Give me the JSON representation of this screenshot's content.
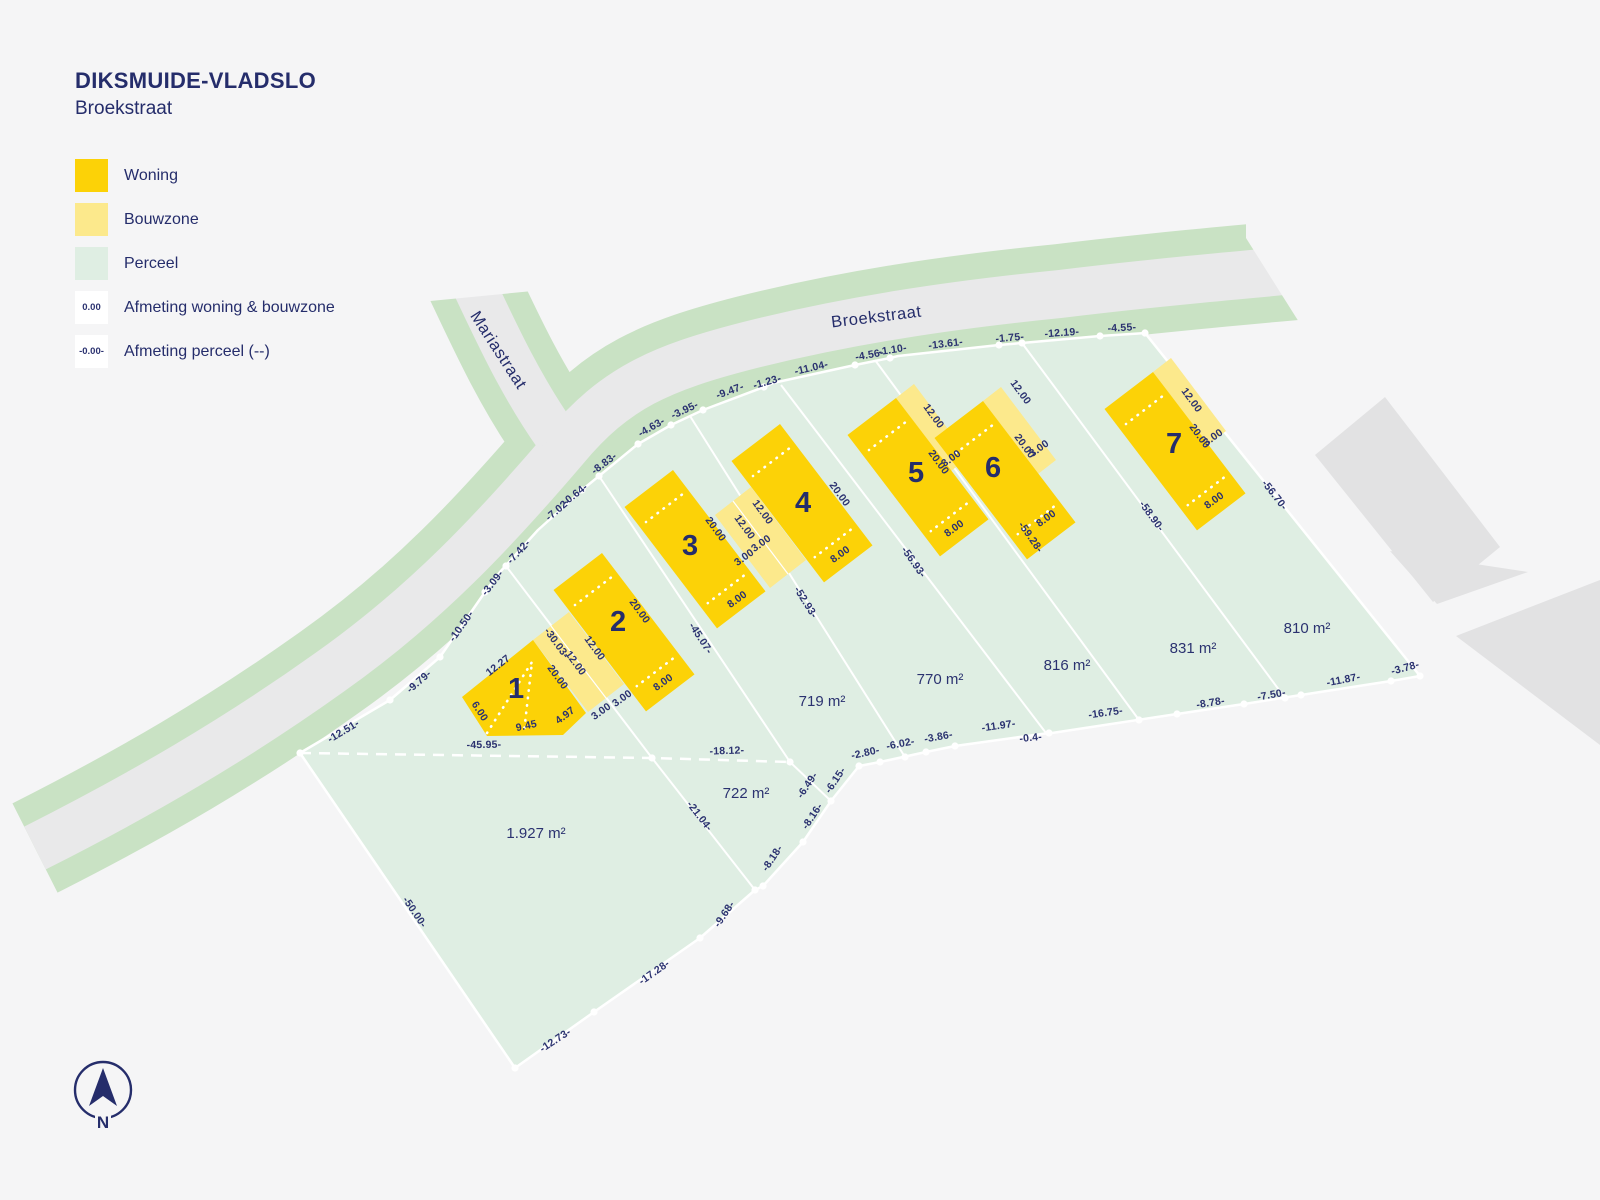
{
  "header": {
    "title": "DIKSMUIDE-VLADSLO",
    "subtitle": "Broekstraat"
  },
  "legend": {
    "items": [
      {
        "label": "Woning",
        "swatch": "woning"
      },
      {
        "label": "Bouwzone",
        "swatch": "bouwzone"
      },
      {
        "label": "Perceel",
        "swatch": "perceel"
      },
      {
        "label": "Afmeting woning & bouwzone",
        "swatch": "text",
        "swatch_text": "0.00"
      },
      {
        "label": "Afmeting perceel (--)",
        "swatch": "text",
        "swatch_text": "-0.00-"
      }
    ]
  },
  "north": {
    "label": "N"
  },
  "colors": {
    "woning": "#fcd207",
    "bouwzone": "#fce98c",
    "perceel": "#dfeee3",
    "road": "#e9e9ea",
    "verge": "#c9e2c4",
    "text": "#2b3270",
    "background": "#f5f5f6"
  },
  "plan": {
    "streets": [
      {
        "name": "Broekstraat",
        "x": 877,
        "y": 322,
        "rot": -7
      },
      {
        "name": "Mariastraat",
        "x": 494,
        "y": 353,
        "rot": 57
      }
    ],
    "lots": [
      {
        "number": "1",
        "x": 516,
        "y": 698
      },
      {
        "number": "2",
        "x": 618,
        "y": 631
      },
      {
        "number": "3",
        "x": 690,
        "y": 555
      },
      {
        "number": "4",
        "x": 803,
        "y": 512
      },
      {
        "number": "5",
        "x": 916,
        "y": 482
      },
      {
        "number": "6",
        "x": 993,
        "y": 477
      },
      {
        "number": "7",
        "x": 1174,
        "y": 453
      }
    ],
    "areas": [
      {
        "text": "1.927 m²",
        "x": 536,
        "y": 838
      },
      {
        "text": "722 m²",
        "x": 746,
        "y": 798
      },
      {
        "text": "719 m²",
        "x": 822,
        "y": 706
      },
      {
        "text": "770 m²",
        "x": 940,
        "y": 684
      },
      {
        "text": "816 m²",
        "x": 1067,
        "y": 670
      },
      {
        "text": "831 m²",
        "x": 1193,
        "y": 653
      },
      {
        "text": "810 m²",
        "x": 1307,
        "y": 633
      }
    ],
    "building_dims": [
      {
        "text": "12.27",
        "x": 500,
        "y": 668,
        "rot": -38
      },
      {
        "text": "20.00",
        "x": 555,
        "y": 679,
        "rot": 54
      },
      {
        "text": "6.00",
        "x": 477,
        "y": 713,
        "rot": 57
      },
      {
        "text": "9.45",
        "x": 527,
        "y": 729,
        "rot": -12
      },
      {
        "text": "4.97",
        "x": 567,
        "y": 718,
        "rot": -37
      },
      {
        "text": "12.00",
        "x": 573,
        "y": 665,
        "rot": 54
      },
      {
        "text": "12.00",
        "x": 592,
        "y": 650,
        "rot": 54
      },
      {
        "text": "3.00",
        "x": 603,
        "y": 714,
        "rot": -36
      },
      {
        "text": "3.00",
        "x": 624,
        "y": 701,
        "rot": -36
      },
      {
        "text": "20.00",
        "x": 637,
        "y": 613,
        "rot": 54
      },
      {
        "text": "8.00",
        "x": 665,
        "y": 685,
        "rot": -36
      },
      {
        "text": "12.00",
        "x": 742,
        "y": 529,
        "rot": 54
      },
      {
        "text": "12.00",
        "x": 760,
        "y": 514,
        "rot": 54
      },
      {
        "text": "3.00",
        "x": 746,
        "y": 560,
        "rot": -36
      },
      {
        "text": "3.00",
        "x": 763,
        "y": 546,
        "rot": -36
      },
      {
        "text": "20.00",
        "x": 713,
        "y": 531,
        "rot": 54
      },
      {
        "text": "8.00",
        "x": 739,
        "y": 602,
        "rot": -36
      },
      {
        "text": "20.00",
        "x": 837,
        "y": 496,
        "rot": 54
      },
      {
        "text": "8.00",
        "x": 842,
        "y": 557,
        "rot": -36
      },
      {
        "text": "20.00",
        "x": 936,
        "y": 464,
        "rot": 54
      },
      {
        "text": "8.00",
        "x": 956,
        "y": 531,
        "rot": -36
      },
      {
        "text": "12.00",
        "x": 931,
        "y": 418,
        "rot": 54
      },
      {
        "text": "3.00",
        "x": 953,
        "y": 461,
        "rot": -36
      },
      {
        "text": "20.00",
        "x": 1022,
        "y": 448,
        "rot": 54
      },
      {
        "text": "8.00",
        "x": 1048,
        "y": 521,
        "rot": -36
      },
      {
        "text": "12.00",
        "x": 1018,
        "y": 394,
        "rot": 54
      },
      {
        "text": "3.00",
        "x": 1041,
        "y": 451,
        "rot": -36
      },
      {
        "text": "20.00",
        "x": 1197,
        "y": 438,
        "rot": 54
      },
      {
        "text": "8.00",
        "x": 1216,
        "y": 503,
        "rot": -36
      },
      {
        "text": "12.00",
        "x": 1189,
        "y": 402,
        "rot": 54
      },
      {
        "text": "3.00",
        "x": 1215,
        "y": 440,
        "rot": -36
      }
    ],
    "parcel_dims": [
      {
        "text": "-12.51-",
        "x": 345,
        "y": 734,
        "rot": -31
      },
      {
        "text": "-9.79-",
        "x": 421,
        "y": 684,
        "rot": -41
      },
      {
        "text": "-10.50-",
        "x": 464,
        "y": 628,
        "rot": -55
      },
      {
        "text": "-3.09-",
        "x": 495,
        "y": 585,
        "rot": -52
      },
      {
        "text": "-7.42-",
        "x": 521,
        "y": 554,
        "rot": -47
      },
      {
        "text": "-7.02-",
        "x": 560,
        "y": 512,
        "rot": -40
      },
      {
        "text": "-0.64-",
        "x": 577,
        "y": 497,
        "rot": -38
      },
      {
        "text": "-8.83-",
        "x": 606,
        "y": 466,
        "rot": -37
      },
      {
        "text": "-4.63-",
        "x": 653,
        "y": 430,
        "rot": -30
      },
      {
        "text": "-3.95-",
        "x": 686,
        "y": 413,
        "rot": -25
      },
      {
        "text": "-9.47-",
        "x": 731,
        "y": 394,
        "rot": -20
      },
      {
        "text": "-1.23-",
        "x": 768,
        "y": 385,
        "rot": -16
      },
      {
        "text": "-11.04-",
        "x": 812,
        "y": 371,
        "rot": -13
      },
      {
        "text": "-4.56-",
        "x": 870,
        "y": 358,
        "rot": -10
      },
      {
        "text": "-1.10-",
        "x": 893,
        "y": 353,
        "rot": -9
      },
      {
        "text": "-13.61-",
        "x": 946,
        "y": 347,
        "rot": -7
      },
      {
        "text": "-1.75-",
        "x": 1010,
        "y": 341,
        "rot": -5
      },
      {
        "text": "-12.19-",
        "x": 1062,
        "y": 336,
        "rot": -4
      },
      {
        "text": "-4.55-",
        "x": 1122,
        "y": 331,
        "rot": -3
      },
      {
        "text": "-56.70-",
        "x": 1272,
        "y": 497,
        "rot": 52
      },
      {
        "text": "-3.78-",
        "x": 1406,
        "y": 671,
        "rot": -15
      },
      {
        "text": "-11.87-",
        "x": 1344,
        "y": 683,
        "rot": -11
      },
      {
        "text": "-7.50-",
        "x": 1272,
        "y": 698,
        "rot": -10
      },
      {
        "text": "-8.78-",
        "x": 1211,
        "y": 706,
        "rot": -9
      },
      {
        "text": "-16.75-",
        "x": 1106,
        "y": 716,
        "rot": -8
      },
      {
        "text": "-0.4-",
        "x": 1031,
        "y": 741,
        "rot": -6
      },
      {
        "text": "-11.97-",
        "x": 999,
        "y": 729,
        "rot": -8
      },
      {
        "text": "-3.86-",
        "x": 939,
        "y": 740,
        "rot": -10
      },
      {
        "text": "-6.02-",
        "x": 901,
        "y": 747,
        "rot": -11
      },
      {
        "text": "-2.80-",
        "x": 866,
        "y": 756,
        "rot": -12
      },
      {
        "text": "-6.15-",
        "x": 838,
        "y": 782,
        "rot": -56
      },
      {
        "text": "-6.49-",
        "x": 810,
        "y": 787,
        "rot": -56
      },
      {
        "text": "-8.16-",
        "x": 815,
        "y": 818,
        "rot": -56
      },
      {
        "text": "-8.18-",
        "x": 775,
        "y": 860,
        "rot": -56
      },
      {
        "text": "-9.68-",
        "x": 727,
        "y": 916,
        "rot": -56
      },
      {
        "text": "-17.28-",
        "x": 656,
        "y": 975,
        "rot": -35
      },
      {
        "text": "-12.73-",
        "x": 557,
        "y": 1043,
        "rot": -33
      },
      {
        "text": "-50.00-",
        "x": 412,
        "y": 914,
        "rot": 56
      },
      {
        "text": "-45.95-",
        "x": 484,
        "y": 748,
        "rot": -1
      },
      {
        "text": "-18.12-",
        "x": 727,
        "y": 754,
        "rot": -2
      },
      {
        "text": "-21.04-",
        "x": 697,
        "y": 818,
        "rot": 52
      },
      {
        "text": "-30.03-",
        "x": 554,
        "y": 645,
        "rot": 54
      },
      {
        "text": "-45.07-",
        "x": 698,
        "y": 640,
        "rot": 57
      },
      {
        "text": "-52.93-",
        "x": 803,
        "y": 604,
        "rot": 58
      },
      {
        "text": "-56.93-",
        "x": 911,
        "y": 564,
        "rot": 55
      },
      {
        "text": "-59.28-",
        "x": 1028,
        "y": 539,
        "rot": 55
      },
      {
        "text": "-58.90-",
        "x": 1149,
        "y": 518,
        "rot": 54
      }
    ]
  }
}
